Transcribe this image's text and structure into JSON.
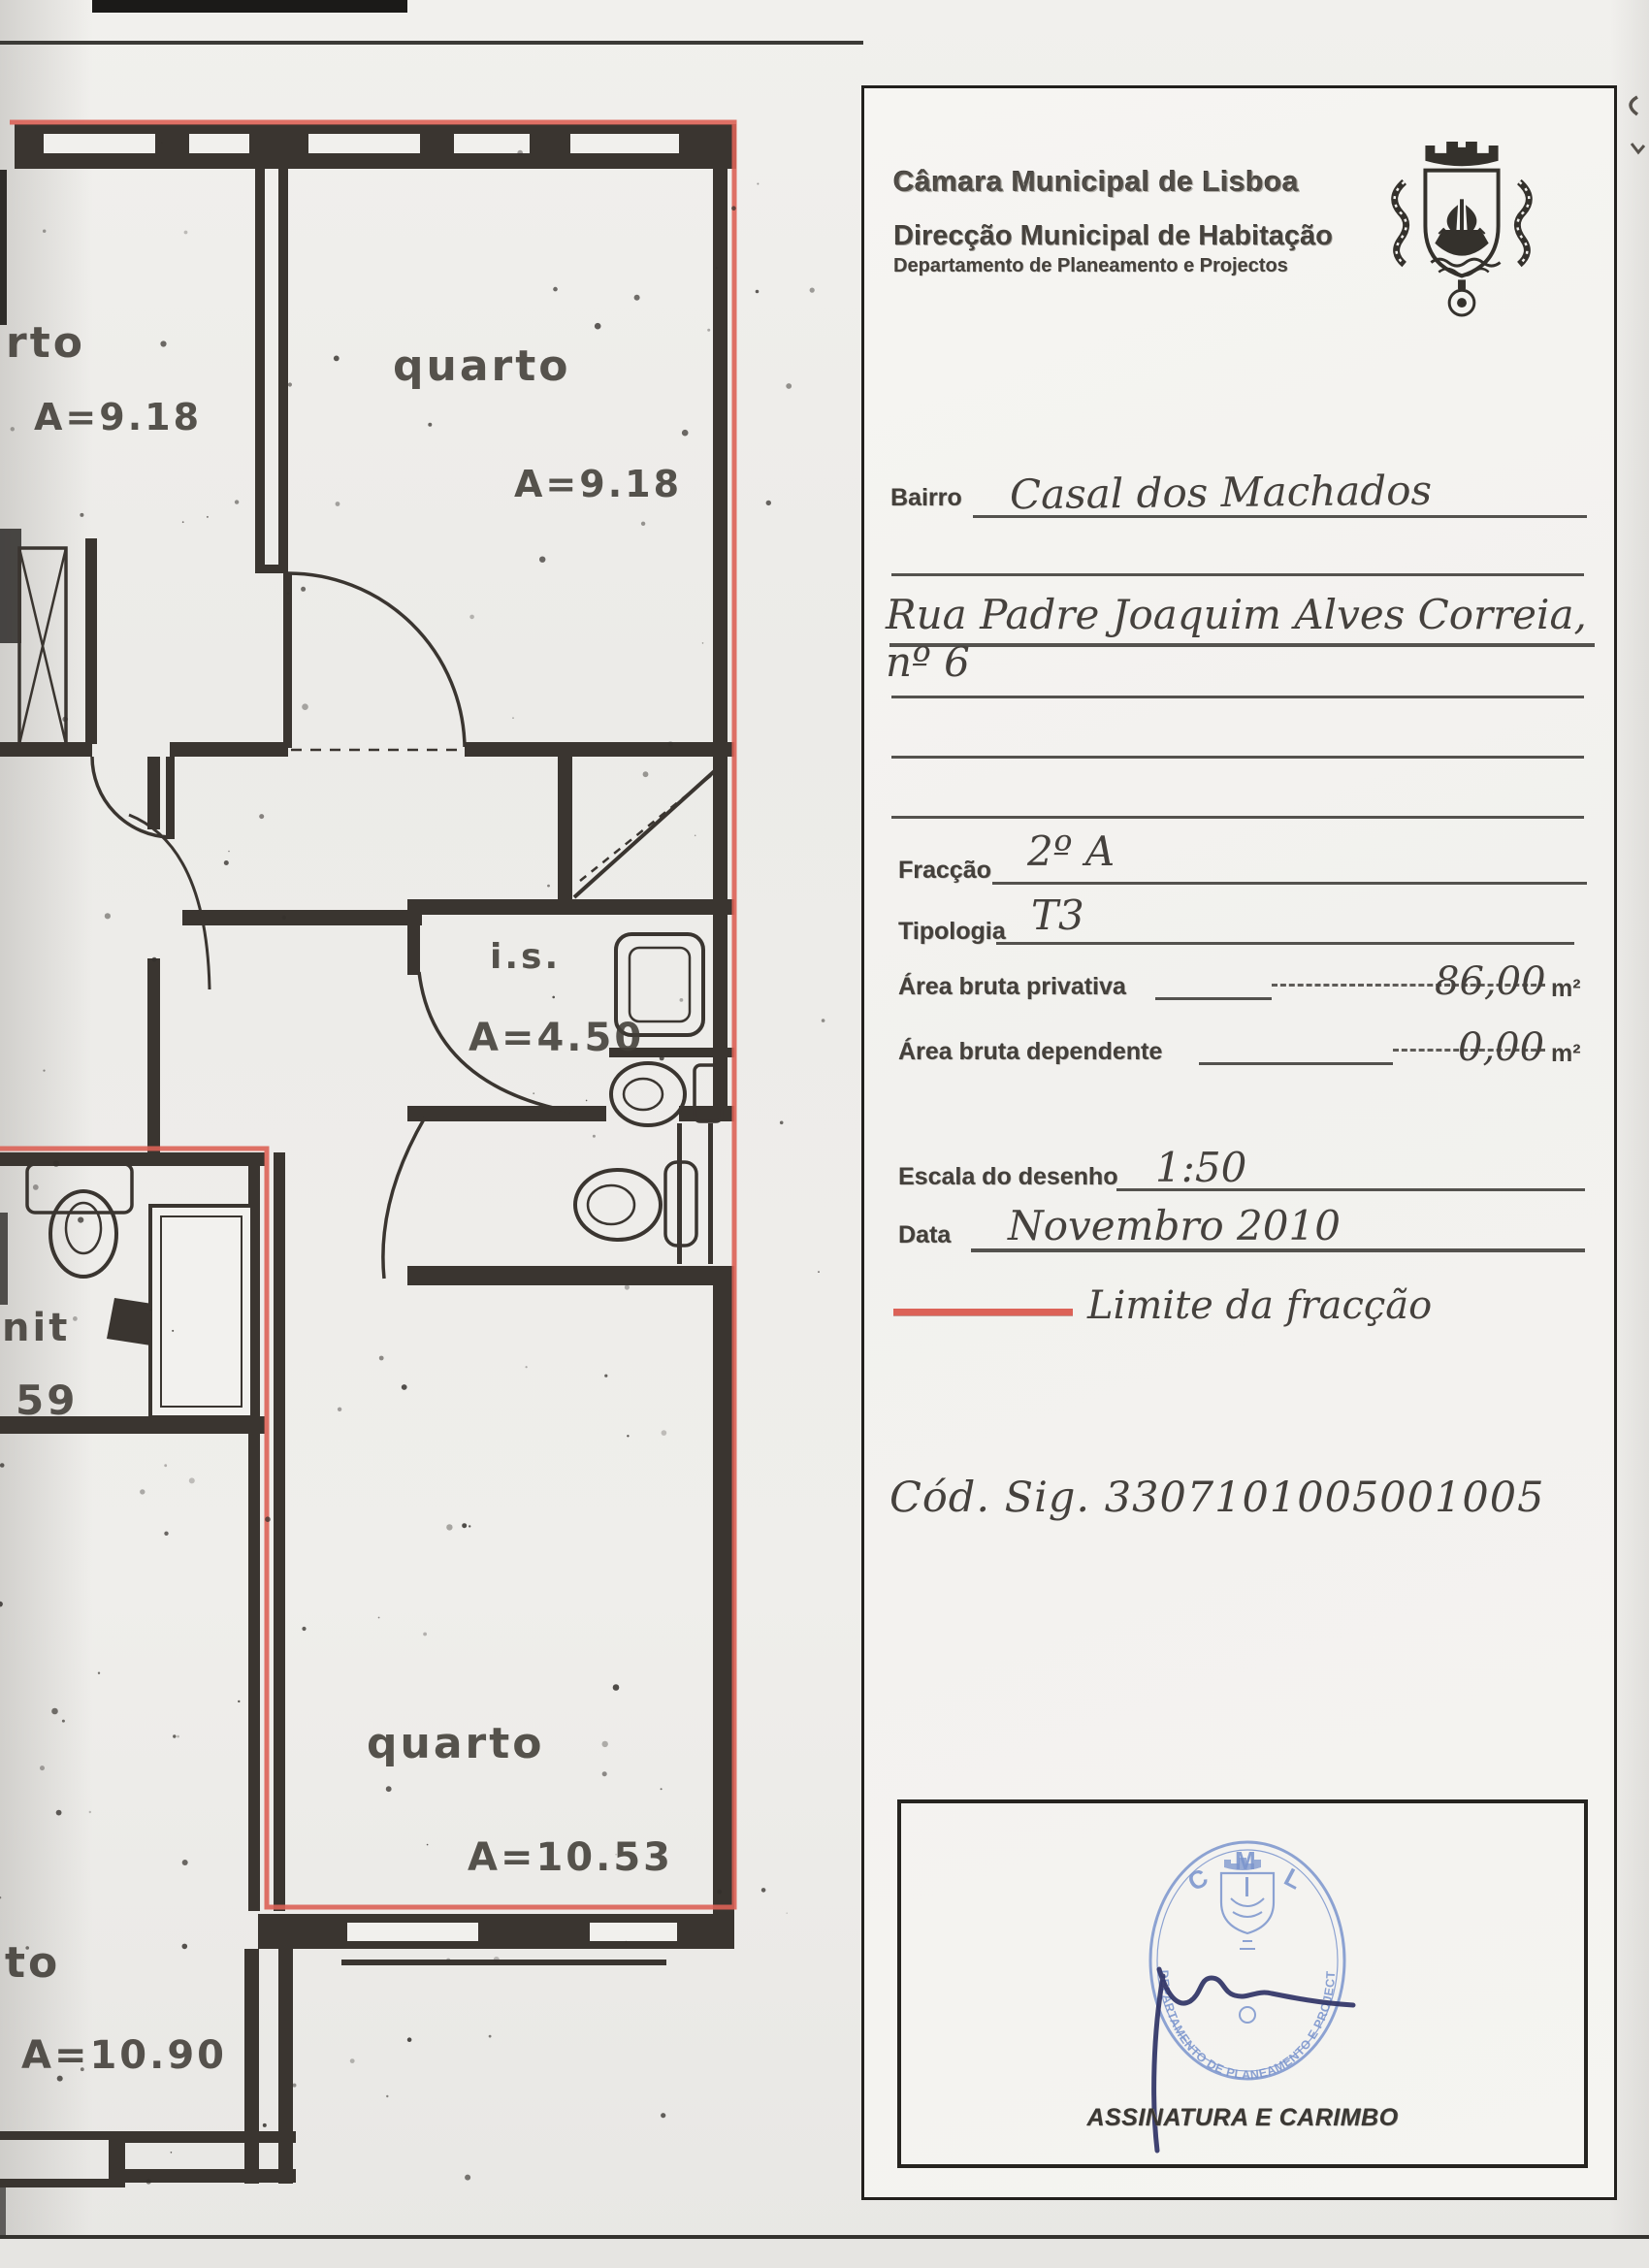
{
  "doc": {
    "org_line1": "Câmara Municipal de Lisboa",
    "org_line2": "Direcção Municipal de Habitação",
    "org_line3": "Departamento de Planeamento e Projectos"
  },
  "form": {
    "bairro_label": "Bairro",
    "bairro_value": "Casal dos Machados",
    "address_value": "Rua Padre Joaquim Alves Correia, nº 6",
    "fraccao_label": "Fracção",
    "fraccao_value": "2º A",
    "tipologia_label": "Tipologia",
    "tipologia_value": "T3",
    "area_privativa_label": "Área bruta privativa",
    "area_privativa_value": "86,00",
    "area_privativa_unit": "m²",
    "area_dependente_label": "Área bruta dependente",
    "area_dependente_value": "0,00",
    "area_dependente_unit": "m²",
    "escala_label": "Escala do desenho",
    "escala_value": "1:50",
    "data_label": "Data",
    "data_value": "Novembro 2010",
    "limite_label": "Limite da fracção",
    "cod_sig_value": "Cód. Sig. 3307101005001005",
    "assinatura_caption": "ASSINATURA E CARIMBO"
  },
  "stamp": {
    "top": "C M L",
    "arc": "DEPARTAMENTO DE PLANEAMENTO E PROJECTOS"
  },
  "plan": {
    "limit_color": "#dc6257",
    "labels": {
      "top_left_name": "rto",
      "top_left_area": "A=9.18",
      "top_right_name": "quarto",
      "top_right_area": "A=9.18",
      "is_name": "i.s.",
      "is_area": "A=4.50",
      "sanit_name": "nit",
      "sanit_area": "59",
      "bottom_name": "quarto",
      "bottom_area": "A=10.53",
      "bottom_left_name": "to",
      "bottom_left_area": "A=10.90"
    }
  }
}
